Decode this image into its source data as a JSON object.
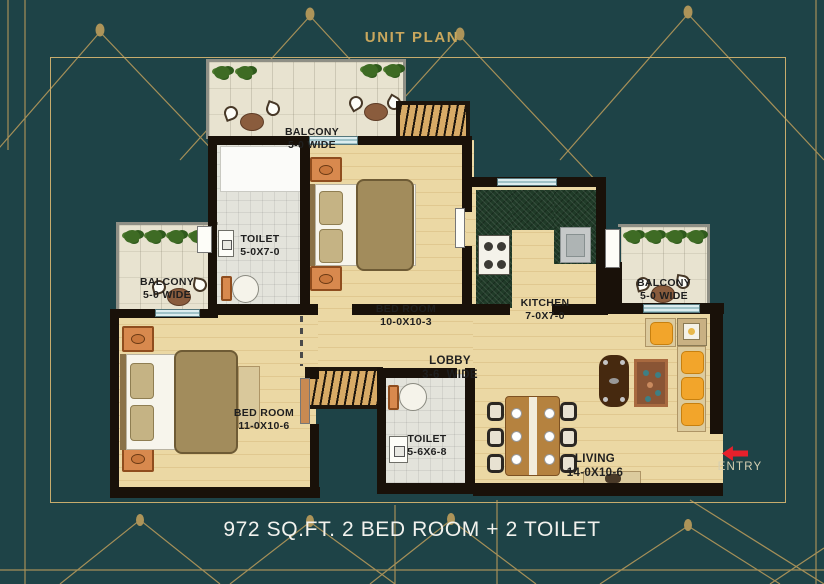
{
  "title": "UNIT PLAN",
  "caption": "972 SQ.FT. 2 BED ROOM + 2 TOILET",
  "entry_label": "ENTRY",
  "rooms": {
    "balcony_top": {
      "name": "BALCONY",
      "dim": "5-0 WIDE"
    },
    "balcony_left": {
      "name": "BALCONY",
      "dim": "5-0 WIDE"
    },
    "balcony_right": {
      "name": "BALCONY",
      "dim": "5-0 WIDE"
    },
    "toilet_1": {
      "name": "TOILET",
      "dim": "5-0X7-0"
    },
    "toilet_2": {
      "name": "TOILET",
      "dim": "5-6X6-8"
    },
    "bedroom_1": {
      "name": "BED ROOM",
      "dim": "10-0X10-3"
    },
    "bedroom_2": {
      "name": "BED ROOM",
      "dim": "11-0X10-6"
    },
    "kitchen": {
      "name": "KITCHEN",
      "dim": "7-0X7-0"
    },
    "lobby": {
      "name": "LOBBY",
      "dim": "3-6  WIDE"
    },
    "living": {
      "name": "LIVING",
      "dim": "14-0X10-6"
    }
  },
  "colors": {
    "background": "#1E4347",
    "gold": "#AD9459",
    "wall": "#191109",
    "entry_red": "#E6202B"
  }
}
